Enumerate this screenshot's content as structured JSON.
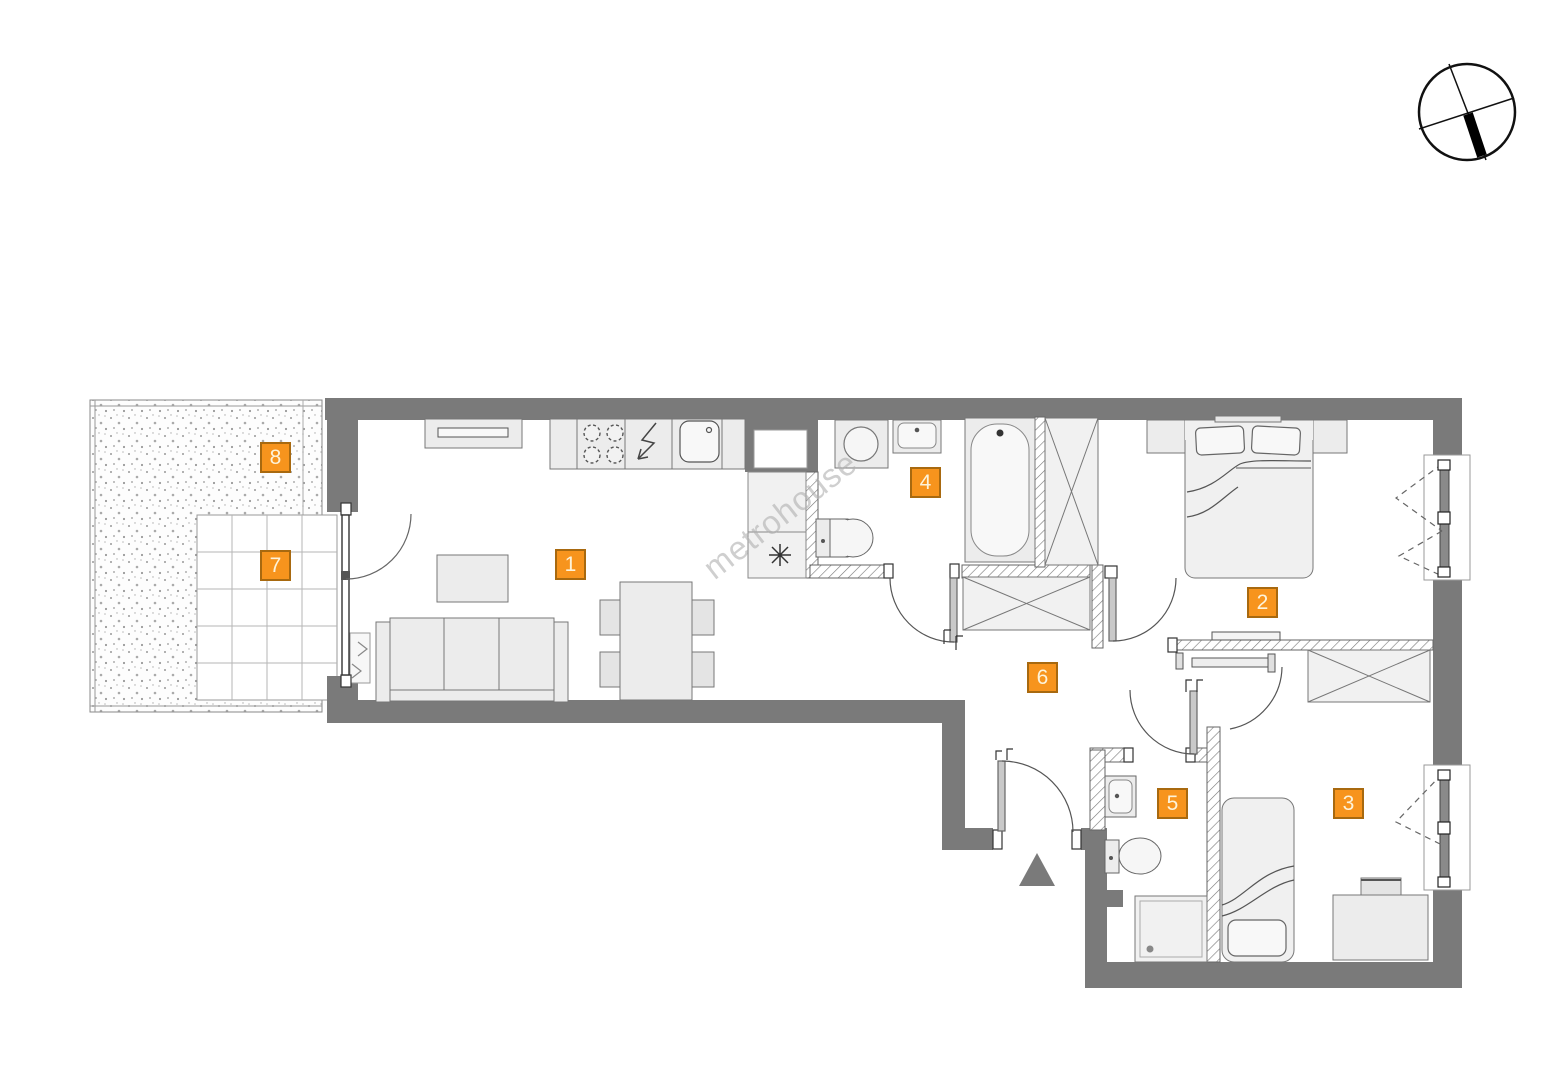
{
  "watermark": {
    "text": "metrohouse"
  },
  "rooms": [
    {
      "number": "1"
    },
    {
      "number": "2"
    },
    {
      "number": "3"
    },
    {
      "number": "4"
    },
    {
      "number": "5"
    },
    {
      "number": "6"
    },
    {
      "number": "7"
    },
    {
      "number": "8"
    }
  ],
  "colors": {
    "wall": "#7a7a7a",
    "hatch_line": "#777777",
    "badge_fill": "#f7941d",
    "badge_border": "#a8690f",
    "badge_text": "#fdf3da",
    "furniture_fill": "#ececec",
    "outline": "#666666",
    "watermark": "#b0b0b0"
  },
  "icons": {
    "north_indicator": "compass-icon",
    "entrance_marker": "triangle-icon",
    "kitchen": [
      "stove-icon",
      "power-arrow-icon",
      "sink-icon"
    ],
    "bathroom": [
      "washing-machine-icon",
      "sink-icon",
      "toilet-icon",
      "bathtub-icon",
      "light-point-icon"
    ],
    "wc": [
      "sink-icon",
      "toilet-icon",
      "shower-icon"
    ]
  }
}
